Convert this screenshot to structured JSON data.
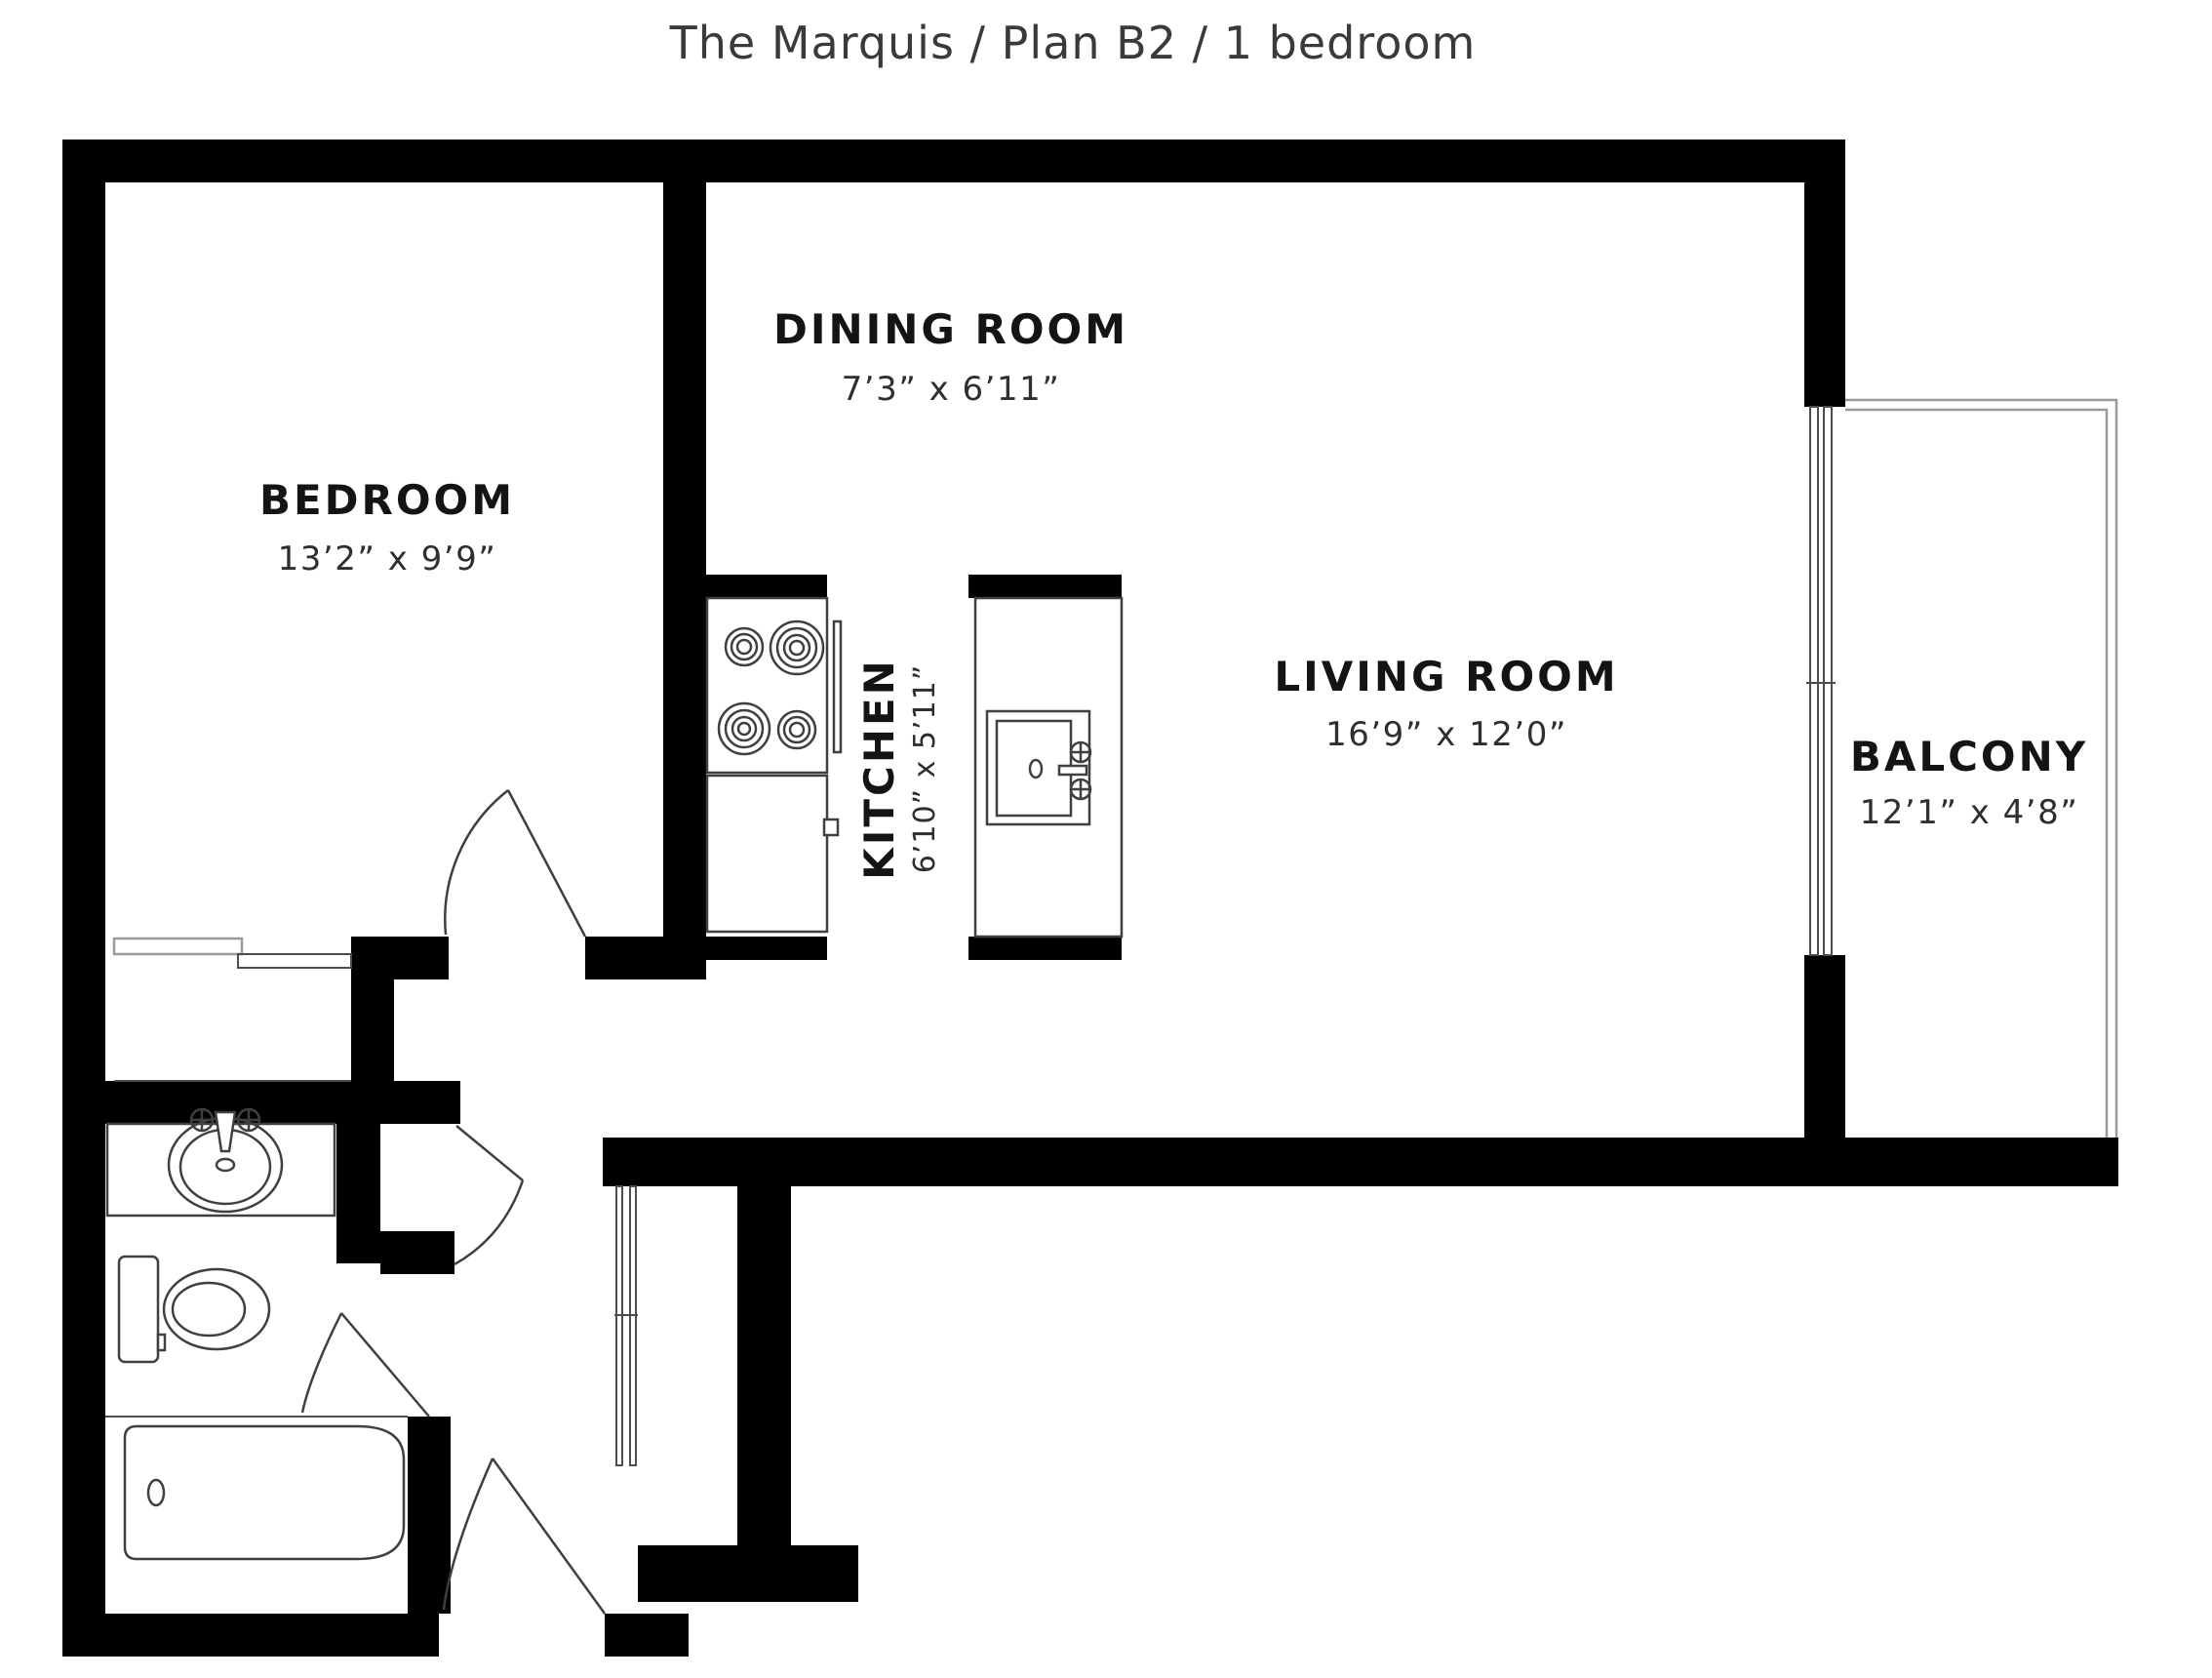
{
  "title": "The Marquis / Plan B2 / 1 bedroom",
  "colors": {
    "background": "#ffffff",
    "walls": "#000000",
    "fixture_lines": "#404040",
    "railing_lines": "#9b9b9b",
    "room_label": "#141414",
    "dims_text": "#2f2f2f",
    "title_text": "#3a3a3a"
  },
  "rooms": {
    "bedroom": {
      "name": "BEDROOM",
      "dims": "13’2” x 9’9”"
    },
    "dining": {
      "name": "DINING ROOM",
      "dims": "7’3” x 6’11”"
    },
    "kitchen": {
      "name": "KITCHEN",
      "dims": "6’10” x 5’11”"
    },
    "living": {
      "name": "LIVING ROOM",
      "dims": "16’9” x 12’0”"
    },
    "balcony": {
      "name": "BALCONY",
      "dims": "12’1” x 4’8”"
    }
  },
  "icons": [
    "stove-icon",
    "kitchen-island-sink-icon",
    "bathroom-sink-icon",
    "toilet-icon",
    "bathtub-icon",
    "door-swing-icon",
    "sliding-door-icon",
    "balcony-railing-icon"
  ]
}
